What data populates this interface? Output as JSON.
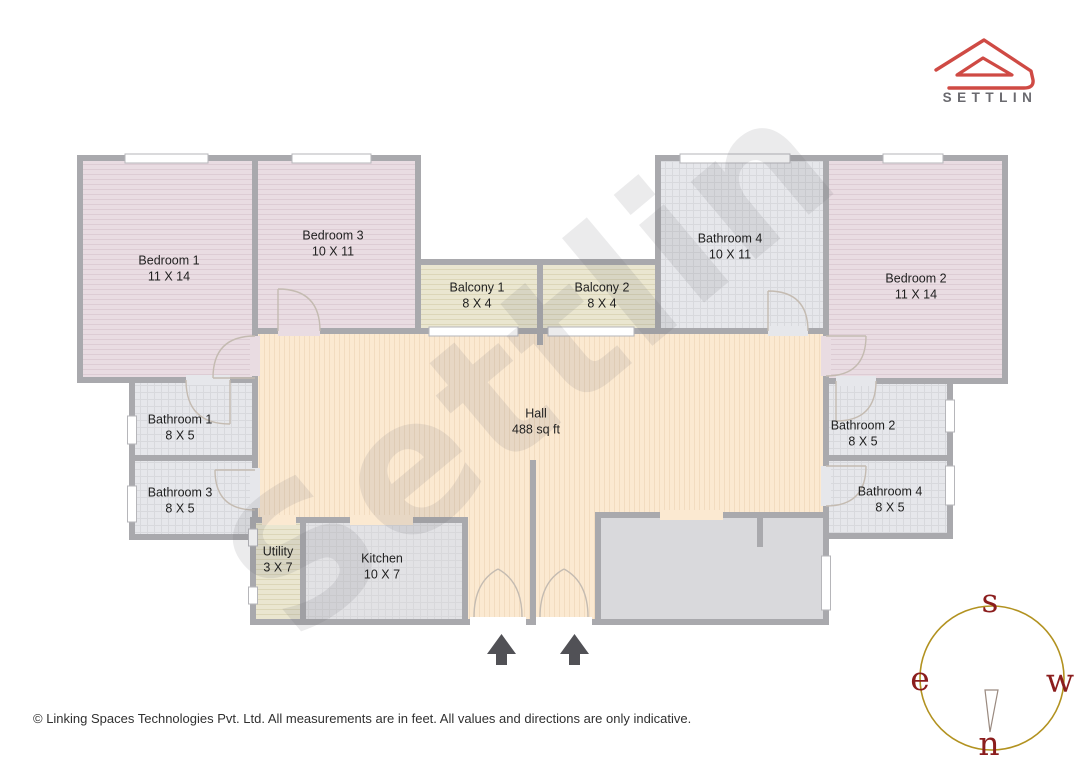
{
  "brand": {
    "name": "SETTLIN"
  },
  "floorplan": {
    "watermark": "Settlin",
    "rooms": [
      {
        "key": "bedroom-1",
        "name": "Bedroom 1",
        "dim": "11 X 14"
      },
      {
        "key": "bedroom-3",
        "name": "Bedroom 3",
        "dim": "10 X 11"
      },
      {
        "key": "balcony-1",
        "name": "Balcony 1",
        "dim": "8 X 4"
      },
      {
        "key": "balcony-2",
        "name": "Balcony 2",
        "dim": "8 X 4"
      },
      {
        "key": "bathroom-4-top",
        "name": "Bathroom 4",
        "dim": "10 X 11"
      },
      {
        "key": "bedroom-2",
        "name": "Bedroom 2",
        "dim": "11 X 14"
      },
      {
        "key": "bathroom-1",
        "name": "Bathroom 1",
        "dim": "8 X 5"
      },
      {
        "key": "bathroom-3",
        "name": "Bathroom 3",
        "dim": "8 X 5"
      },
      {
        "key": "hall",
        "name": "Hall",
        "dim": "488 sq ft"
      },
      {
        "key": "bathroom-2",
        "name": "Bathroom 2",
        "dim": "8 X 5"
      },
      {
        "key": "bathroom-4-right",
        "name": "Bathroom 4",
        "dim": "8 X 5"
      },
      {
        "key": "utility",
        "name": "Utility",
        "dim": "3 X 7"
      },
      {
        "key": "kitchen",
        "name": "Kitchen",
        "dim": "10 X 7"
      }
    ],
    "compass": {
      "top": "s",
      "left": "e",
      "right": "w",
      "bottom": "n"
    }
  },
  "footer": {
    "copyright": "© Linking Spaces Technologies Pvt. Ltd. All measurements are in feet. All values and directions are only indicative."
  },
  "colors": {
    "brand_red": "#cf4a44",
    "brand_text": "#6a6a6f",
    "wall": "#a9a9ad",
    "bedroom_fill": "#e9dce2",
    "bathroom_fill": "#e6e7eb",
    "balcony_fill": "#eae6d0",
    "hall_fill": "#fbe9d1",
    "kitchen_fill": "#e2e2e5",
    "extra_room_fill": "#d9d9dc",
    "compass_circle": "#b29220",
    "compass_letters": "#8b1d1d",
    "entrance_arrow": "#515156"
  }
}
